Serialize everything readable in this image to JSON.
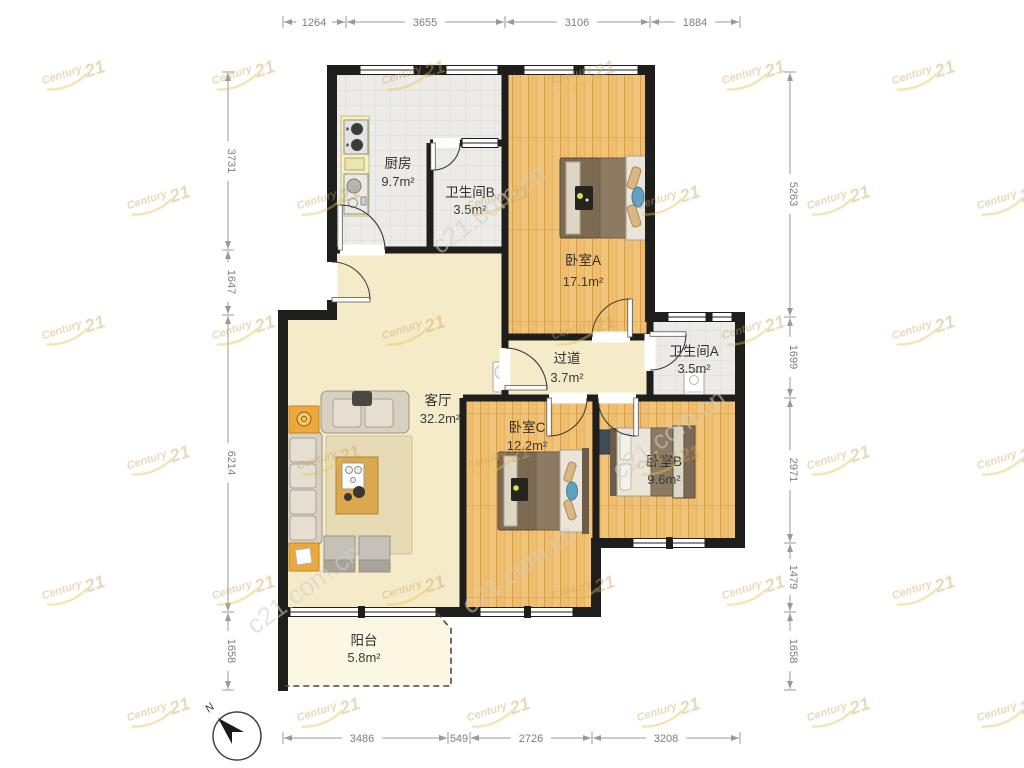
{
  "plan": {
    "rooms": [
      {
        "id": "kitchen",
        "name": "厨房",
        "area": "9.7m²"
      },
      {
        "id": "bath-b",
        "name": "卫生间B",
        "area": "3.5m²"
      },
      {
        "id": "bedroom-a",
        "name": "卧室A",
        "area": "17.1m²"
      },
      {
        "id": "hallway",
        "name": "过道",
        "area": "3.7m²"
      },
      {
        "id": "bath-a",
        "name": "卫生间A",
        "area": "3.5m²"
      },
      {
        "id": "living",
        "name": "客厅",
        "area": "32.2m²"
      },
      {
        "id": "bedroom-c",
        "name": "卧室C",
        "area": "12.2m²"
      },
      {
        "id": "bedroom-b",
        "name": "卧室B",
        "area": "9.6m²"
      },
      {
        "id": "balcony",
        "name": "阳台",
        "area": "5.8m²"
      }
    ],
    "dimensions": {
      "top": [
        "1264",
        "3655",
        "3106",
        "1884"
      ],
      "left": [
        "3731",
        "1647",
        "6214",
        "1658"
      ],
      "right": [
        "5263",
        "1699",
        "2971",
        "1479",
        "1658"
      ],
      "bottom": [
        "3486",
        "549",
        "2726",
        "3208"
      ]
    },
    "compass": {
      "north": "N"
    },
    "watermark": {
      "brand_top": "Century",
      "brand_num": "21",
      "site": "c21.com.cn"
    },
    "colors": {
      "wall": "#1e1e1c",
      "wood": "#f1c377",
      "tile": "#ecebe7",
      "cream": "#f6ebc9",
      "balcony": "#fbf7e2",
      "gold": "#c9a85c",
      "dim": "#9a9a9a"
    }
  }
}
